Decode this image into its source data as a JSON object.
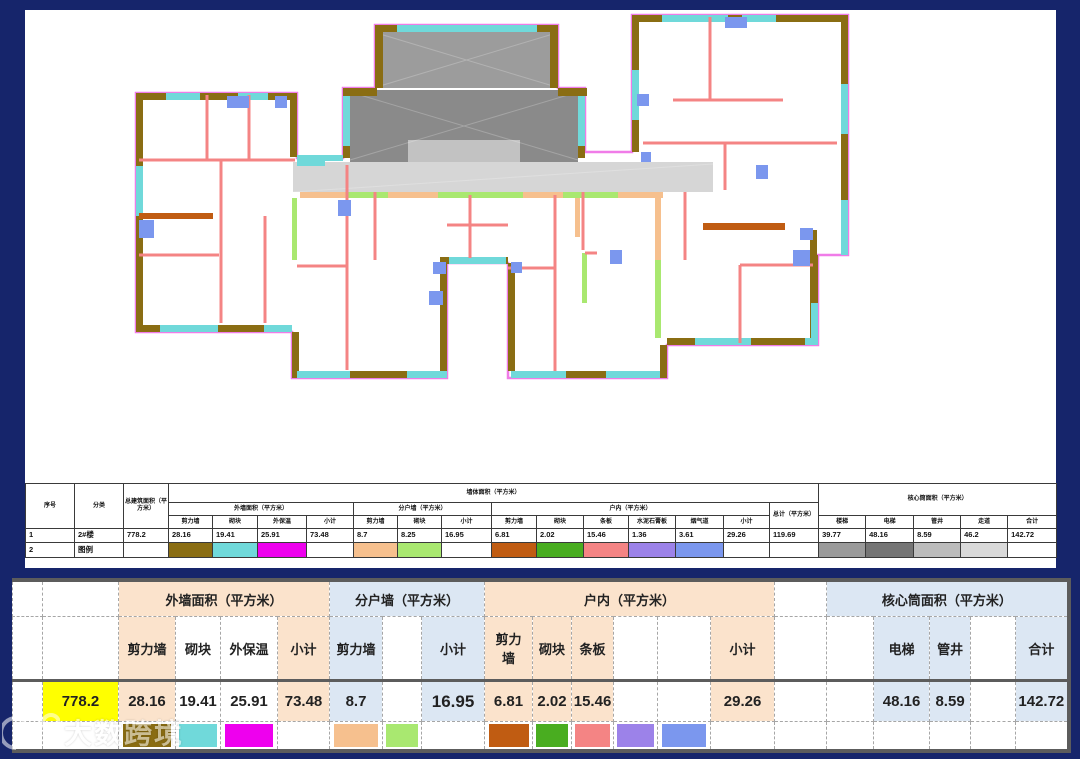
{
  "colors": {
    "background": "#16256b",
    "panel": "#ffffff",
    "peach_group_bg": "#fbe3cc",
    "blue_group_bg": "#dce7f3",
    "yellow_highlight": "#ffff00",
    "red_accent": "#d42222",
    "rule_gray": "#5c5c5c"
  },
  "legend_colors": {
    "ext_shear_wall": "#8a6d13",
    "ext_block": "#70d9da",
    "ext_insulation": "#ee00ee",
    "party_shear_wall": "#f6c08e",
    "party_block": "#a9e870",
    "indoor_shear_wall": "#c05c12",
    "indoor_block": "#49ad20",
    "indoor_strip_panel": "#f48484",
    "indoor_gypsum_board": "#9c82e9",
    "indoor_smoke_flue": "#7b97ee",
    "core_stair": "#9a9a9a",
    "core_elevator": "#757575",
    "core_pipe_shaft": "#bcbcbc",
    "core_corridor": "#d9d9d9"
  },
  "summary_table": {
    "headers": {
      "serial": "序号",
      "category": "分类",
      "total_floor_area": "总建筑面积（平方米）",
      "wall_area_group": "墙体面积（平方米）",
      "ext_group": "外墙面积（平方米）",
      "party_group": "分户墙（平方米）",
      "indoor_group": "户内（平方米）",
      "grand_total": "总计（平方米）",
      "core_group": "核心筒面积（平方米）",
      "shear_wall": "剪力墙",
      "block": "砌块",
      "insulation": "外保温",
      "subtotal": "小计",
      "strip_panel": "条板",
      "gypsum_board": "水泥石膏板",
      "smoke_flue": "烟气道",
      "stair": "楼梯",
      "elevator": "电梯",
      "pipe_shaft": "管井",
      "corridor": "走道",
      "total": "合计"
    },
    "data_row": {
      "serial": "1",
      "name": "2#楼",
      "total_floor_area": "778.2",
      "ext": [
        "28.16",
        "19.41",
        "25.91",
        "73.48"
      ],
      "party": [
        "8.7",
        "8.25",
        "16.95"
      ],
      "indoor": [
        "6.81",
        "2.02",
        "15.46",
        "1.36",
        "3.61",
        "29.26"
      ],
      "grand_total": "119.69",
      "core": [
        "39.77",
        "48.16",
        "8.59",
        "46.2",
        "142.72"
      ]
    },
    "legend_row": {
      "serial": "2",
      "name": "图例"
    }
  },
  "detail_table": {
    "groups": {
      "ext": "外墙面积（平方米）",
      "party": "分户墙（平方米）",
      "indoor": "户内（平方米）",
      "core": "核心筒面积（平方米）"
    },
    "headers": {
      "shear_wall": "剪力墙",
      "block": "砌块",
      "insulation": "外保温",
      "subtotal": "小计",
      "strip_panel": "条板",
      "elevator": "电梯",
      "pipe_shaft": "管井",
      "total": "合计"
    },
    "values": {
      "total_floor_area": "778.2",
      "ext_shear": "28.16",
      "ext_block": "19.41",
      "ext_insulation": "25.91",
      "ext_subtotal": "73.48",
      "party_shear": "8.7",
      "party_subtotal": "16.95",
      "indoor_shear": "6.81",
      "indoor_block": "2.02",
      "indoor_panel": "15.46",
      "indoor_subtotal": "29.26",
      "core_elevator": "48.16",
      "core_shaft": "8.59",
      "core_total": "142.72"
    }
  },
  "watermark": {
    "text": "大数跨境"
  }
}
